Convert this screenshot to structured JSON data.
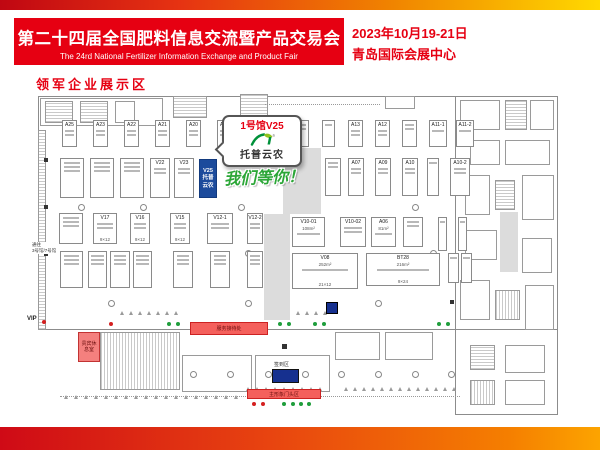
{
  "banner": {
    "title_cn": "第二十四届全国肥料信息交流暨产品交易会",
    "title_en": "The 24rd National Fertilizer Information Exchange and Product Fair",
    "date": "2023年10月19-21日",
    "venue": "青岛国际会展中心",
    "section_label": "领军企业展示区"
  },
  "callout": {
    "hall_booth": "1号馆V25",
    "brand": "托普云农",
    "slogan": "我们等你！"
  },
  "highlight_booth": {
    "code": "V25",
    "line1": "托普",
    "line2": "云农"
  },
  "colors": {
    "accent_red": "#e60012",
    "booth_blue": "#1c4b9c",
    "slogan_green": "#2ba637",
    "corridor_gray": "#dcdcdc",
    "box_salmon": "#f4605c",
    "checkin_blue": "#16308f"
  },
  "floorplan": {
    "vip_label": "VIP",
    "corridor_label_1": "通往",
    "corridor_label_2": "3号馆/7号馆",
    "vip_lounge": "贵宾休息室",
    "service_desk": "服务接待处",
    "checkin_label": "签到区",
    "main_gate": "主形象门头区",
    "booths": [
      {
        "x": 62,
        "y": 120,
        "w": 15,
        "h": 27,
        "code": "A25",
        "s": 2
      },
      {
        "x": 93,
        "y": 120,
        "w": 15,
        "h": 27,
        "code": "A23",
        "s": 2
      },
      {
        "x": 124,
        "y": 120,
        "w": 15,
        "h": 27,
        "code": "A22",
        "s": 2
      },
      {
        "x": 155,
        "y": 120,
        "w": 15,
        "h": 27,
        "code": "A21",
        "s": 2
      },
      {
        "x": 186,
        "y": 120,
        "w": 15,
        "h": 27,
        "code": "A20",
        "s": 2
      },
      {
        "x": 217,
        "y": 120,
        "w": 15,
        "h": 27,
        "code": "A19",
        "s": 2
      },
      {
        "x": 248,
        "y": 120,
        "w": 15,
        "h": 27,
        "code": "",
        "s": 2
      },
      {
        "x": 295,
        "y": 120,
        "w": 14,
        "h": 27,
        "code": "",
        "s": 2
      },
      {
        "x": 322,
        "y": 120,
        "w": 13,
        "h": 27,
        "code": "",
        "s": 1
      },
      {
        "x": 348,
        "y": 120,
        "w": 15,
        "h": 27,
        "code": "A13",
        "s": 2
      },
      {
        "x": 375,
        "y": 120,
        "w": 15,
        "h": 27,
        "code": "A12",
        "s": 2
      },
      {
        "x": 402,
        "y": 120,
        "w": 15,
        "h": 27,
        "code": "",
        "s": 2
      },
      {
        "x": 429,
        "y": 120,
        "w": 18,
        "h": 27,
        "code": "A11-1",
        "s": 1
      },
      {
        "x": 456,
        "y": 120,
        "w": 18,
        "h": 27,
        "code": "A11-2",
        "s": 1
      },
      {
        "x": 60,
        "y": 158,
        "w": 24,
        "h": 40,
        "code": "",
        "s": 3
      },
      {
        "x": 90,
        "y": 158,
        "w": 24,
        "h": 40,
        "code": "",
        "s": 3
      },
      {
        "x": 120,
        "y": 158,
        "w": 24,
        "h": 40,
        "code": "",
        "s": 3
      },
      {
        "x": 150,
        "y": 158,
        "w": 20,
        "h": 40,
        "code": "V22",
        "s": 2
      },
      {
        "x": 174,
        "y": 158,
        "w": 20,
        "h": 40,
        "code": "V23",
        "s": 2
      },
      {
        "x": 325,
        "y": 158,
        "w": 16,
        "h": 38,
        "code": "",
        "s": 2
      },
      {
        "x": 348,
        "y": 158,
        "w": 16,
        "h": 38,
        "code": "A07",
        "s": 2
      },
      {
        "x": 375,
        "y": 158,
        "w": 16,
        "h": 38,
        "code": "A09",
        "s": 2
      },
      {
        "x": 402,
        "y": 158,
        "w": 16,
        "h": 38,
        "code": "A10",
        "s": 2
      },
      {
        "x": 427,
        "y": 158,
        "w": 12,
        "h": 38,
        "code": "",
        "s": 1
      },
      {
        "x": 450,
        "y": 158,
        "w": 20,
        "h": 38,
        "code": "A10-2",
        "s": 2
      },
      {
        "x": 59,
        "y": 213,
        "w": 24,
        "h": 31,
        "code": "",
        "s": 3
      },
      {
        "x": 93,
        "y": 213,
        "w": 24,
        "h": 31,
        "code": "V17",
        "s": 2,
        "dims": "9×12"
      },
      {
        "x": 130,
        "y": 213,
        "w": 20,
        "h": 31,
        "code": "V16",
        "s": 2,
        "dims": "9×12"
      },
      {
        "x": 170,
        "y": 213,
        "w": 20,
        "h": 31,
        "code": "V15",
        "s": 2,
        "dims": "9×12"
      },
      {
        "x": 207,
        "y": 213,
        "w": 26,
        "h": 31,
        "code": "V12-1",
        "s": 2
      },
      {
        "x": 247,
        "y": 213,
        "w": 16,
        "h": 31,
        "code": "V12-2",
        "s": 2
      },
      {
        "x": 292,
        "y": 217,
        "w": 33,
        "h": 30,
        "code": "V10-01",
        "s": 1,
        "size": "108m²"
      },
      {
        "x": 340,
        "y": 217,
        "w": 26,
        "h": 30,
        "code": "V10-02",
        "s": 2
      },
      {
        "x": 371,
        "y": 217,
        "w": 25,
        "h": 30,
        "code": "A06",
        "s": 1,
        "size": "81m²"
      },
      {
        "x": 403,
        "y": 217,
        "w": 20,
        "h": 30,
        "code": "",
        "s": 2
      },
      {
        "x": 438,
        "y": 217,
        "w": 9,
        "h": 34,
        "code": "",
        "s": 1
      },
      {
        "x": 458,
        "y": 217,
        "w": 9,
        "h": 34,
        "code": "",
        "s": 1
      },
      {
        "x": 60,
        "y": 251,
        "w": 23,
        "h": 37,
        "code": "",
        "s": 3
      },
      {
        "x": 88,
        "y": 251,
        "w": 19,
        "h": 37,
        "code": "",
        "s": 3
      },
      {
        "x": 110,
        "y": 251,
        "w": 20,
        "h": 37,
        "code": "",
        "s": 3
      },
      {
        "x": 133,
        "y": 251,
        "w": 19,
        "h": 37,
        "code": "",
        "s": 3
      },
      {
        "x": 173,
        "y": 251,
        "w": 20,
        "h": 37,
        "code": "",
        "s": 3
      },
      {
        "x": 210,
        "y": 251,
        "w": 20,
        "h": 37,
        "code": "",
        "s": 3
      },
      {
        "x": 247,
        "y": 251,
        "w": 16,
        "h": 37,
        "code": "",
        "s": 3
      },
      {
        "x": 292,
        "y": 253,
        "w": 66,
        "h": 36,
        "code": "V08",
        "s": 1,
        "size": "252m²",
        "dims": "21×12"
      },
      {
        "x": 366,
        "y": 253,
        "w": 74,
        "h": 33,
        "code": "BT28",
        "s": 1,
        "size": "216m²",
        "dims": "9×24"
      },
      {
        "x": 448,
        "y": 253,
        "w": 11,
        "h": 30,
        "code": "",
        "s": 1
      },
      {
        "x": 461,
        "y": 253,
        "w": 11,
        "h": 30,
        "code": "",
        "s": 1
      }
    ],
    "structures": [
      {
        "t": "wall",
        "x": 38,
        "y": 96,
        "w": 520,
        "h": 234
      },
      {
        "t": "wall",
        "x": 455,
        "y": 96,
        "w": 103,
        "h": 319
      },
      {
        "t": "room",
        "x": 40,
        "y": 98,
        "w": 123,
        "h": 28
      },
      {
        "t": "hatch",
        "x": 45,
        "y": 101,
        "w": 28,
        "h": 22
      },
      {
        "t": "hatch",
        "x": 80,
        "y": 101,
        "w": 28,
        "h": 22
      },
      {
        "t": "room",
        "x": 115,
        "y": 101,
        "w": 20,
        "h": 22
      },
      {
        "t": "hatch",
        "x": 173,
        "y": 96,
        "w": 34,
        "h": 22
      },
      {
        "t": "hatch",
        "x": 240,
        "y": 94,
        "w": 28,
        "h": 24
      },
      {
        "t": "room",
        "x": 385,
        "y": 96,
        "w": 30,
        "h": 13
      },
      {
        "t": "dotline",
        "x": 265,
        "y": 104,
        "w": 115,
        "h": 0
      },
      {
        "t": "gray",
        "x": 283,
        "y": 148,
        "w": 38,
        "h": 66
      },
      {
        "t": "gray",
        "x": 264,
        "y": 214,
        "w": 26,
        "h": 106
      },
      {
        "t": "gray",
        "x": 500,
        "y": 212,
        "w": 18,
        "h": 60
      },
      {
        "t": "hatch",
        "x": 38,
        "y": 130,
        "w": 8,
        "h": 200
      },
      {
        "t": "room",
        "x": 460,
        "y": 100,
        "w": 40,
        "h": 30
      },
      {
        "t": "hatch",
        "x": 505,
        "y": 100,
        "w": 22,
        "h": 30
      },
      {
        "t": "room",
        "x": 530,
        "y": 100,
        "w": 24,
        "h": 30
      },
      {
        "t": "room",
        "x": 470,
        "y": 140,
        "w": 30,
        "h": 25
      },
      {
        "t": "room",
        "x": 505,
        "y": 140,
        "w": 45,
        "h": 25
      },
      {
        "t": "room",
        "x": 465,
        "y": 175,
        "w": 25,
        "h": 40
      },
      {
        "t": "hatch",
        "x": 495,
        "y": 180,
        "w": 20,
        "h": 30
      },
      {
        "t": "room",
        "x": 522,
        "y": 175,
        "w": 32,
        "h": 45
      },
      {
        "t": "room",
        "x": 465,
        "y": 230,
        "w": 32,
        "h": 30
      },
      {
        "t": "room",
        "x": 522,
        "y": 238,
        "w": 30,
        "h": 35
      },
      {
        "t": "room",
        "x": 460,
        "y": 280,
        "w": 30,
        "h": 40
      },
      {
        "t": "hatchv",
        "x": 495,
        "y": 290,
        "w": 25,
        "h": 30
      },
      {
        "t": "room",
        "x": 525,
        "y": 285,
        "w": 29,
        "h": 45
      },
      {
        "t": "hatch",
        "x": 470,
        "y": 345,
        "w": 25,
        "h": 25
      },
      {
        "t": "room",
        "x": 505,
        "y": 345,
        "w": 40,
        "h": 28
      },
      {
        "t": "hatchv",
        "x": 470,
        "y": 380,
        "w": 25,
        "h": 25
      },
      {
        "t": "room",
        "x": 505,
        "y": 380,
        "w": 40,
        "h": 25
      },
      {
        "t": "hatchv",
        "x": 100,
        "y": 332,
        "w": 80,
        "h": 58
      },
      {
        "t": "room",
        "x": 182,
        "y": 355,
        "w": 70,
        "h": 37
      },
      {
        "t": "room",
        "x": 255,
        "y": 355,
        "w": 75,
        "h": 37
      },
      {
        "t": "black",
        "x": 282,
        "y": 344,
        "w": 5,
        "h": 5
      },
      {
        "t": "room",
        "x": 335,
        "y": 332,
        "w": 45,
        "h": 28
      },
      {
        "t": "room",
        "x": 385,
        "y": 332,
        "w": 48,
        "h": 28
      },
      {
        "t": "blue",
        "x": 326,
        "y": 302,
        "w": 12,
        "h": 12
      },
      {
        "t": "dotline",
        "x": 60,
        "y": 396,
        "w": 400,
        "h": 0
      },
      {
        "t": "black",
        "x": 44,
        "y": 158,
        "w": 4,
        "h": 4
      },
      {
        "t": "black",
        "x": 44,
        "y": 205,
        "w": 4,
        "h": 4
      },
      {
        "t": "black",
        "x": 44,
        "y": 252,
        "w": 4,
        "h": 4
      },
      {
        "t": "black",
        "x": 450,
        "y": 158,
        "w": 4,
        "h": 4
      },
      {
        "t": "black",
        "x": 450,
        "y": 300,
        "w": 4,
        "h": 4
      }
    ],
    "circles": [
      {
        "x": 78,
        "y": 204
      },
      {
        "x": 140,
        "y": 204
      },
      {
        "x": 238,
        "y": 204
      },
      {
        "x": 412,
        "y": 204
      },
      {
        "x": 245,
        "y": 250
      },
      {
        "x": 430,
        "y": 250
      },
      {
        "x": 108,
        "y": 300
      },
      {
        "x": 245,
        "y": 300
      },
      {
        "x": 375,
        "y": 300
      },
      {
        "x": 190,
        "y": 371
      },
      {
        "x": 227,
        "y": 371
      },
      {
        "x": 265,
        "y": 371
      },
      {
        "x": 302,
        "y": 371
      },
      {
        "x": 338,
        "y": 371
      },
      {
        "x": 375,
        "y": 371
      },
      {
        "x": 412,
        "y": 371
      },
      {
        "x": 448,
        "y": 371
      }
    ],
    "dots": [
      {
        "x": 42,
        "y": 320,
        "c": "r"
      },
      {
        "x": 109,
        "y": 322,
        "c": "r"
      },
      {
        "x": 167,
        "y": 322,
        "c": "g"
      },
      {
        "x": 176,
        "y": 322,
        "c": "g"
      },
      {
        "x": 278,
        "y": 322,
        "c": "g"
      },
      {
        "x": 287,
        "y": 322,
        "c": "g"
      },
      {
        "x": 313,
        "y": 322,
        "c": "g"
      },
      {
        "x": 322,
        "y": 322,
        "c": "g"
      },
      {
        "x": 437,
        "y": 322,
        "c": "g"
      },
      {
        "x": 446,
        "y": 322,
        "c": "g"
      },
      {
        "x": 252,
        "y": 402,
        "c": "r"
      },
      {
        "x": 261,
        "y": 402,
        "c": "r"
      },
      {
        "x": 282,
        "y": 402,
        "c": "g"
      },
      {
        "x": 291,
        "y": 402,
        "c": "g"
      },
      {
        "x": 299,
        "y": 402,
        "c": "g"
      },
      {
        "x": 307,
        "y": 402,
        "c": "g"
      }
    ],
    "tri_rows": [
      {
        "y": 311,
        "x1": 120,
        "x2": 180,
        "step": 9
      },
      {
        "y": 311,
        "x1": 296,
        "x2": 330,
        "step": 9
      },
      {
        "y": 387,
        "x1": 246,
        "x2": 318,
        "step": 9
      },
      {
        "y": 387,
        "x1": 344,
        "x2": 458,
        "step": 9
      },
      {
        "y": 395,
        "x1": 64,
        "x2": 238,
        "step": 10
      }
    ]
  }
}
